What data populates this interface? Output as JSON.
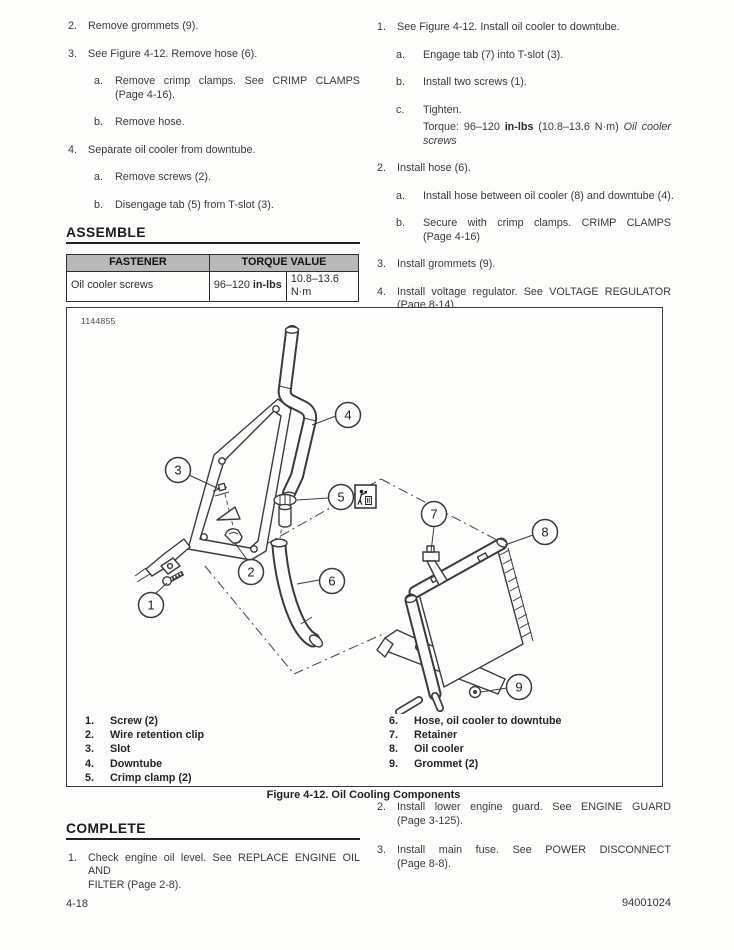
{
  "colors": {
    "table_header_bg": "#b9b9b9",
    "body_text": "#3a3a3a",
    "heading_rule": "#222222"
  },
  "left_column": {
    "steps": [
      {
        "num": "2.",
        "text": "Remove grommets (9)."
      },
      {
        "num": "3.",
        "text": "See Figure 4-12. Remove hose (6).",
        "substeps": [
          {
            "letter": "a.",
            "lines": [
              "Remove crimp clamps. See CRIMP CLAMPS",
              "(Page 4-16)."
            ]
          },
          {
            "letter": "b.",
            "text": "Remove hose."
          }
        ]
      },
      {
        "num": "4.",
        "text": "Separate oil cooler from downtube.",
        "substeps": [
          {
            "letter": "a.",
            "text": "Remove screws (2)."
          },
          {
            "letter": "b.",
            "text": "Disengage tab (5) from T-slot (3)."
          }
        ]
      }
    ],
    "assemble_heading": "ASSEMBLE",
    "torque_table": {
      "fastener_header": "FASTENER",
      "torque_header": "TORQUE VALUE",
      "fastener": "Oil cooler screws",
      "torque_us_prefix": "96–120 ",
      "torque_us_unit": "in-lbs",
      "torque_metric": "10.8–13.6 N·m"
    }
  },
  "right_column": {
    "steps": [
      {
        "num": "1.",
        "text": "See Figure 4-12. Install oil cooler to downtube.",
        "substeps": [
          {
            "letter": "a.",
            "text": "Engage tab (7) into T-slot (3)."
          },
          {
            "letter": "b.",
            "text": "Install two screws (1)."
          },
          {
            "letter": "c.",
            "text": "Tighten.",
            "torque": {
              "prefix": "Torque: 96–120 ",
              "unit": "in-lbs",
              "middle": " (10.8–13.6 N·m) ",
              "italic": "Oil cooler screws"
            }
          }
        ]
      },
      {
        "num": "2.",
        "text": "Install hose (6).",
        "substeps": [
          {
            "letter": "a.",
            "text": "Install hose between oil cooler (8) and downtube (4)."
          },
          {
            "letter": "b.",
            "lines": [
              "Secure with crimp clamps. CRIMP CLAMPS",
              "(Page 4-16)"
            ]
          }
        ]
      },
      {
        "num": "3.",
        "text": "Install grommets (9)."
      },
      {
        "num": "4.",
        "lines": [
          "Install voltage regulator. See VOLTAGE REGULATOR",
          "(Page 8-14)."
        ]
      }
    ]
  },
  "figure": {
    "photo_number": "1144855",
    "caption": "Figure 4-12. Oil Cooling Components",
    "callouts": [
      "1",
      "2",
      "3",
      "4",
      "5",
      "6",
      "7",
      "8",
      "9"
    ],
    "dispose_icon_name": "discard-component-icon",
    "legend_left": [
      {
        "num": "1.",
        "label": "Screw (2)"
      },
      {
        "num": "2.",
        "label": "Wire retention clip"
      },
      {
        "num": "3.",
        "label": "Slot"
      },
      {
        "num": "4.",
        "label": "Downtube"
      },
      {
        "num": "5.",
        "label": "Crimp clamp (2)"
      }
    ],
    "legend_right": [
      {
        "num": "6.",
        "label": "Hose, oil cooler to downtube"
      },
      {
        "num": "7.",
        "label": "Retainer"
      },
      {
        "num": "8.",
        "label": "Oil cooler"
      },
      {
        "num": "9.",
        "label": "Grommet (2)"
      }
    ]
  },
  "complete_section": {
    "heading": "COMPLETE",
    "steps": [
      {
        "num": "1.",
        "lines": [
          "Check engine oil level. See REPLACE ENGINE OIL AND",
          "FILTER (Page 2-8)."
        ]
      }
    ]
  },
  "right_bottom": {
    "steps": [
      {
        "num": "2.",
        "lines": [
          "Install lower engine guard. See ENGINE GUARD",
          "(Page 3-125)."
        ]
      },
      {
        "num": "3.",
        "lines": [
          "Install main fuse. See POWER DISCONNECT",
          "(Page 8-8)."
        ]
      }
    ]
  },
  "footer": {
    "page_number": "4-18",
    "document_number": "94001024"
  }
}
